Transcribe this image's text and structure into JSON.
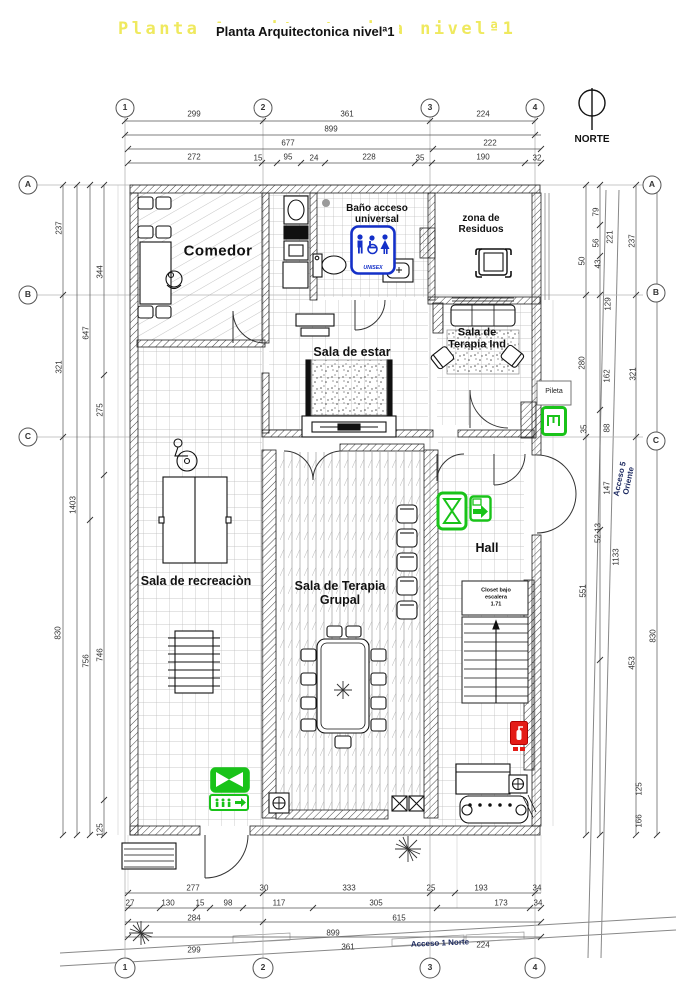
{
  "title": {
    "main": "Planta Arquitectonica nivelª1",
    "shadow": "Planta Arquitectonica nivelª1"
  },
  "north": {
    "label": "NORTE"
  },
  "signs": {
    "unisex": {
      "label": "UNISEX"
    }
  },
  "colors": {
    "accent_green": "#19c319",
    "accent_blue": "#1430c8",
    "accent_red": "#e41c17",
    "title_shadow": "#efe95e"
  },
  "rooms": [
    "Comedor",
    "Baño acceso universal",
    "zona de Residuos",
    "Sala de Terapia Ind",
    "Sala de estar",
    "Sala de recreaciòn",
    "Sala de Terapia Grupal",
    "Hall",
    "Pileta",
    "Closet bajo escalera"
  ],
  "access_routes": [
    "Acceso 1 Norte",
    "Acceso 5 Oriente"
  ],
  "grid_axes": {
    "columns": [
      "1",
      "2",
      "3",
      "4"
    ],
    "rows": [
      "A",
      "B",
      "C"
    ]
  },
  "dimensions_cm": {
    "top": [
      299,
      361,
      224,
      899,
      677,
      222,
      272,
      15,
      95,
      24,
      228,
      35,
      190,
      32
    ],
    "bottom": [
      277,
      30,
      333,
      25,
      193,
      34,
      27,
      130,
      15,
      98,
      117,
      305,
      173,
      284,
      615,
      899,
      299,
      361,
      224
    ],
    "left": [
      237,
      344,
      647,
      321,
      275,
      1403,
      830,
      756,
      746,
      125
    ],
    "right": [
      79,
      56,
      43,
      50,
      221,
      237,
      129,
      162,
      321,
      280,
      88,
      35,
      147,
      52.13,
      1133,
      551,
      453,
      830,
      125,
      166
    ]
  },
  "labels": [
    {
      "name": "grid-bubble-1-top",
      "text": "1",
      "x": 125,
      "y": 108,
      "cls": "bubble"
    },
    {
      "name": "grid-bubble-2-top",
      "text": "2",
      "x": 263,
      "y": 108,
      "cls": "bubble"
    },
    {
      "name": "grid-bubble-3-top",
      "text": "3",
      "x": 430,
      "y": 108,
      "cls": "bubble"
    },
    {
      "name": "grid-bubble-4-top",
      "text": "4",
      "x": 535,
      "y": 108,
      "cls": "bubble"
    },
    {
      "name": "grid-bubble-1-bottom",
      "text": "1",
      "x": 125,
      "y": 968,
      "cls": "bubble"
    },
    {
      "name": "grid-bubble-2-bottom",
      "text": "2",
      "x": 263,
      "y": 968,
      "cls": "bubble"
    },
    {
      "name": "grid-bubble-3-bottom",
      "text": "3",
      "x": 430,
      "y": 968,
      "cls": "bubble"
    },
    {
      "name": "grid-bubble-4-bottom",
      "text": "4",
      "x": 535,
      "y": 968,
      "cls": "bubble"
    },
    {
      "name": "grid-bubble-a-left",
      "text": "A",
      "x": 28,
      "y": 185,
      "cls": "bubble"
    },
    {
      "name": "grid-bubble-b-left",
      "text": "B",
      "x": 28,
      "y": 295,
      "cls": "bubble"
    },
    {
      "name": "grid-bubble-c-left",
      "text": "C",
      "x": 28,
      "y": 437,
      "cls": "bubble"
    },
    {
      "name": "grid-bubble-a-right",
      "text": "A",
      "x": 652,
      "y": 185,
      "cls": "bubble"
    },
    {
      "name": "grid-bubble-b-right",
      "text": "B",
      "x": 656,
      "y": 293,
      "cls": "bubble"
    },
    {
      "name": "grid-bubble-c-right",
      "text": "C",
      "x": 656,
      "y": 441,
      "cls": "bubble"
    },
    {
      "name": "room-label-comedor",
      "text": "Comedor",
      "x": 218,
      "y": 252,
      "cls": "room-lg"
    },
    {
      "name": "room-label-bano",
      "text": "Baño acceso\nuniversal",
      "x": 377,
      "y": 214,
      "cls": "room-10"
    },
    {
      "name": "room-label-residuos",
      "text": "zona de\nResiduos",
      "x": 481,
      "y": 224,
      "cls": "room-10"
    },
    {
      "name": "room-label-terapia-ind",
      "text": "Sala de\nTerapia Ind",
      "x": 477,
      "y": 339,
      "cls": "room-11"
    },
    {
      "name": "room-label-sala-de-estar",
      "text": "Sala de estar",
      "x": 352,
      "y": 352,
      "cls": "room-13"
    },
    {
      "name": "room-label-recreacion",
      "text": "Sala de recreaciòn",
      "x": 196,
      "y": 581,
      "cls": "room-13"
    },
    {
      "name": "room-label-terapia-grupal",
      "text": "Sala de Terapia\nGrupal",
      "x": 340,
      "y": 593,
      "cls": "room-13"
    },
    {
      "name": "room-label-hall",
      "text": "Hall",
      "x": 487,
      "y": 548,
      "cls": "room-13"
    },
    {
      "name": "room-label-pileta",
      "text": "Pileta",
      "x": 554,
      "y": 392,
      "cls": "pileta"
    },
    {
      "name": "room-label-closet",
      "text": "Closet bajo\nescalera\n1.71",
      "x": 496,
      "y": 598,
      "cls": "closet"
    },
    {
      "name": "access-1-norte-label",
      "text": "Acceso 1 Norte",
      "x": 440,
      "y": 944,
      "rot": -2.5,
      "cls": "access"
    },
    {
      "name": "access-5-oriente-label",
      "text": "Acceso 5 Oriente",
      "x": 625,
      "y": 480,
      "rot": -78,
      "cls": "access"
    },
    {
      "name": "dimension-label",
      "text": "299",
      "x": 194,
      "y": 115,
      "cls": "dim"
    },
    {
      "name": "dimension-label",
      "text": "361",
      "x": 347,
      "y": 115,
      "cls": "dim"
    },
    {
      "name": "dimension-label",
      "text": "224",
      "x": 483,
      "y": 115,
      "cls": "dim"
    },
    {
      "name": "dimension-label",
      "text": "899",
      "x": 331,
      "y": 130,
      "cls": "dim"
    },
    {
      "name": "dimension-label",
      "text": "677",
      "x": 288,
      "y": 144,
      "cls": "dim"
    },
    {
      "name": "dimension-label",
      "text": "222",
      "x": 490,
      "y": 144,
      "cls": "dim"
    },
    {
      "name": "dimension-label",
      "text": "272",
      "x": 194,
      "y": 158,
      "cls": "dim"
    },
    {
      "name": "dimension-label",
      "text": "15",
      "x": 258,
      "y": 159,
      "cls": "dim"
    },
    {
      "name": "dimension-label",
      "text": "95",
      "x": 288,
      "y": 158,
      "cls": "dim"
    },
    {
      "name": "dimension-label",
      "text": "24",
      "x": 314,
      "y": 159,
      "cls": "dim"
    },
    {
      "name": "dimension-label",
      "text": "228",
      "x": 369,
      "y": 158,
      "cls": "dim"
    },
    {
      "name": "dimension-label",
      "text": "35",
      "x": 420,
      "y": 159,
      "cls": "dim"
    },
    {
      "name": "dimension-label",
      "text": "190",
      "x": 483,
      "y": 158,
      "cls": "dim"
    },
    {
      "name": "dimension-label",
      "text": "32",
      "x": 537,
      "y": 159,
      "cls": "dim"
    },
    {
      "name": "dimension-label",
      "text": "277",
      "x": 193,
      "y": 889,
      "cls": "dim"
    },
    {
      "name": "dimension-label",
      "text": "30",
      "x": 264,
      "y": 889,
      "cls": "dim"
    },
    {
      "name": "dimension-label",
      "text": "333",
      "x": 349,
      "y": 889,
      "cls": "dim"
    },
    {
      "name": "dimension-label",
      "text": "25",
      "x": 431,
      "y": 889,
      "cls": "dim"
    },
    {
      "name": "dimension-label",
      "text": "193",
      "x": 481,
      "y": 889,
      "cls": "dim"
    },
    {
      "name": "dimension-label",
      "text": "34",
      "x": 537,
      "y": 889,
      "cls": "dim"
    },
    {
      "name": "dimension-label",
      "text": "27",
      "x": 130,
      "y": 904,
      "cls": "dim"
    },
    {
      "name": "dimension-label",
      "text": "130",
      "x": 168,
      "y": 904,
      "cls": "dim"
    },
    {
      "name": "dimension-label",
      "text": "15",
      "x": 200,
      "y": 904,
      "cls": "dim"
    },
    {
      "name": "dimension-label",
      "text": "98",
      "x": 228,
      "y": 904,
      "cls": "dim"
    },
    {
      "name": "dimension-label",
      "text": "117",
      "x": 279,
      "y": 904,
      "cls": "dim"
    },
    {
      "name": "dimension-label",
      "text": "305",
      "x": 376,
      "y": 904,
      "cls": "dim"
    },
    {
      "name": "dimension-label",
      "text": "173",
      "x": 501,
      "y": 904,
      "cls": "dim"
    },
    {
      "name": "dimension-label",
      "text": "34",
      "x": 538,
      "y": 904,
      "cls": "dim"
    },
    {
      "name": "dimension-label",
      "text": "284",
      "x": 194,
      "y": 919,
      "cls": "dim"
    },
    {
      "name": "dimension-label",
      "text": "615",
      "x": 399,
      "y": 919,
      "cls": "dim"
    },
    {
      "name": "dimension-label",
      "text": "899",
      "x": 333,
      "y": 934,
      "cls": "dim"
    },
    {
      "name": "dimension-label",
      "text": "299",
      "x": 194,
      "y": 951,
      "cls": "dim"
    },
    {
      "name": "dimension-label",
      "text": "361",
      "x": 348,
      "y": 948,
      "cls": "dim"
    },
    {
      "name": "dimension-label",
      "text": "224",
      "x": 483,
      "y": 946,
      "cls": "dim"
    },
    {
      "name": "dimension-label",
      "text": "237",
      "x": 60,
      "y": 228,
      "rot": -90,
      "cls": "dim"
    },
    {
      "name": "dimension-label",
      "text": "344",
      "x": 101,
      "y": 272,
      "rot": -90,
      "cls": "dim"
    },
    {
      "name": "dimension-label",
      "text": "647",
      "x": 87,
      "y": 333,
      "rot": -90,
      "cls": "dim"
    },
    {
      "name": "dimension-label",
      "text": "321",
      "x": 60,
      "y": 367,
      "rot": -90,
      "cls": "dim"
    },
    {
      "name": "dimension-label",
      "text": "275",
      "x": 101,
      "y": 410,
      "rot": -90,
      "cls": "dim"
    },
    {
      "name": "dimension-label",
      "text": "1403",
      "x": 74,
      "y": 505,
      "rot": -90,
      "cls": "dim"
    },
    {
      "name": "dimension-label",
      "text": "830",
      "x": 59,
      "y": 633,
      "rot": -90,
      "cls": "dim"
    },
    {
      "name": "dimension-label",
      "text": "756",
      "x": 87,
      "y": 661,
      "rot": -90,
      "cls": "dim"
    },
    {
      "name": "dimension-label",
      "text": "746",
      "x": 101,
      "y": 655,
      "rot": -90,
      "cls": "dim"
    },
    {
      "name": "dimension-label",
      "text": "125",
      "x": 101,
      "y": 830,
      "rot": -90,
      "cls": "dim"
    },
    {
      "name": "dimension-label",
      "text": "79",
      "x": 597,
      "y": 212,
      "rot": -90,
      "cls": "dim"
    },
    {
      "name": "dimension-label",
      "text": "56",
      "x": 597,
      "y": 243,
      "rot": -90,
      "cls": "dim"
    },
    {
      "name": "dimension-label",
      "text": "43",
      "x": 599,
      "y": 264,
      "rot": -90,
      "cls": "dim"
    },
    {
      "name": "dimension-label",
      "text": "50",
      "x": 583,
      "y": 261,
      "rot": -90,
      "cls": "dim"
    },
    {
      "name": "dimension-label",
      "text": "221",
      "x": 611,
      "y": 237,
      "rot": -90,
      "cls": "dim"
    },
    {
      "name": "dimension-label",
      "text": "237",
      "x": 633,
      "y": 241,
      "rot": -90,
      "cls": "dim"
    },
    {
      "name": "dimension-label",
      "text": "129",
      "x": 609,
      "y": 304,
      "rot": -90,
      "cls": "dim"
    },
    {
      "name": "dimension-label",
      "text": "162",
      "x": 608,
      "y": 376,
      "rot": -90,
      "cls": "dim"
    },
    {
      "name": "dimension-label",
      "text": "321",
      "x": 634,
      "y": 374,
      "rot": -90,
      "cls": "dim"
    },
    {
      "name": "dimension-label",
      "text": "280",
      "x": 583,
      "y": 363,
      "rot": -90,
      "cls": "dim"
    },
    {
      "name": "dimension-label",
      "text": "88",
      "x": 608,
      "y": 428,
      "rot": -90,
      "cls": "dim"
    },
    {
      "name": "dimension-label",
      "text": "35",
      "x": 585,
      "y": 429,
      "rot": -90,
      "cls": "dim"
    },
    {
      "name": "dimension-label",
      "text": "147",
      "x": 608,
      "y": 488,
      "rot": -90,
      "cls": "dim"
    },
    {
      "name": "dimension-label",
      "text": "52.13",
      "x": 599,
      "y": 533,
      "rot": -90,
      "cls": "dim"
    },
    {
      "name": "dimension-label",
      "text": "1133",
      "x": 617,
      "y": 557,
      "rot": -90,
      "cls": "dim"
    },
    {
      "name": "dimension-label",
      "text": "551",
      "x": 584,
      "y": 591,
      "rot": -90,
      "cls": "dim"
    },
    {
      "name": "dimension-label",
      "text": "453",
      "x": 633,
      "y": 663,
      "rot": -90,
      "cls": "dim"
    },
    {
      "name": "dimension-label",
      "text": "830",
      "x": 654,
      "y": 636,
      "rot": -90,
      "cls": "dim"
    },
    {
      "name": "dimension-label",
      "text": "125",
      "x": 640,
      "y": 789,
      "rot": -90,
      "cls": "dim"
    },
    {
      "name": "dimension-label",
      "text": "166",
      "x": 640,
      "y": 821,
      "rot": -90,
      "cls": "dim"
    }
  ]
}
